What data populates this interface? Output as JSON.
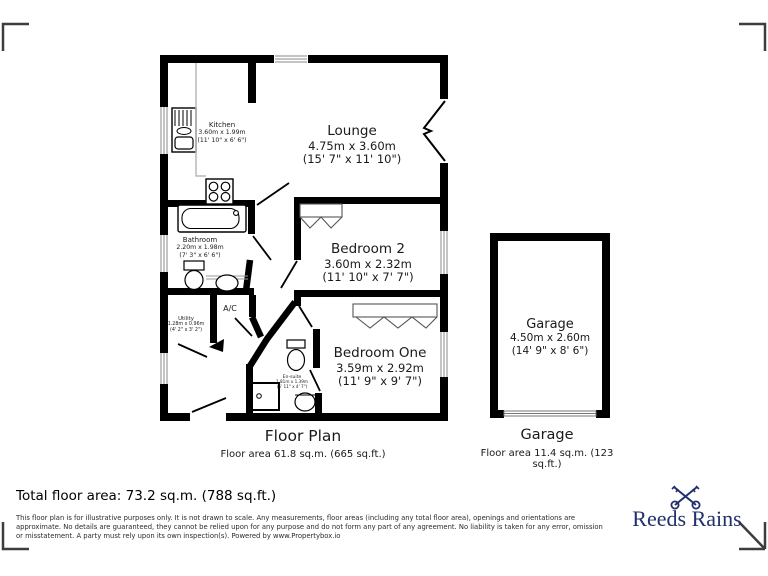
{
  "rooms": {
    "kitchen": {
      "name": "Kitchen",
      "metric": "3.60m x 1.99m",
      "imperial": "(11' 10\" x 6' 6\")"
    },
    "lounge": {
      "name": "Lounge",
      "metric": "4.75m x 3.60m",
      "imperial": "(15' 7\" x 11' 10\")"
    },
    "bathroom": {
      "name": "Bathroom",
      "metric": "2.20m x 1.98m",
      "imperial": "(7' 3\" x 6' 6\")"
    },
    "bedroom2": {
      "name": "Bedroom 2",
      "metric": "3.60m x 2.32m",
      "imperial": "(11' 10\" x 7' 7\")"
    },
    "ac": {
      "name": "A/C"
    },
    "utility": {
      "name": "Utility",
      "metric": "1.28m x 0.96m",
      "imperial": "(4' 2\" x 3' 2\")"
    },
    "bedroom1": {
      "name": "Bedroom One",
      "metric": "3.59m x 2.92m",
      "imperial": "(11' 9\" x 9' 7\")"
    },
    "ensuite": {
      "name": "En-suite",
      "metric": "1.81m x 1.39m",
      "imperial": "(5' 11\" x 4' 7\")"
    },
    "garage": {
      "name": "Garage",
      "metric": "4.50m x 2.60m",
      "imperial": "(14' 9\" x 8' 6\")"
    }
  },
  "captions": {
    "floorplan_title": "Floor Plan",
    "floorplan_area": "Floor area 61.8 sq.m. (665 sq.ft.)",
    "garage_title": "Garage",
    "garage_area": "Floor area 11.4 sq.m. (123 sq.ft.)"
  },
  "footer": {
    "total": "Total floor area: 73.2 sq.m. (788 sq.ft.)",
    "disclaimer": "This floor plan is for illustrative purposes only. It is not drawn to scale. Any measurements, floor areas (including any total floor area), openings and orientations are approximate. No details are guaranteed, they cannot be relied upon for any purpose and do not form any part of any agreement. No liability is taken for any error, omission or misstatement. A party must rely upon its own inspection(s). Powered by www.Propertybox.io"
  },
  "brand": {
    "name": "Reeds Rains",
    "logo_icon": "crossed-keys-icon"
  },
  "colors": {
    "wall": "#000000",
    "window_line": "#8a8a8a",
    "logo_navy": "#22306b",
    "background": "#ffffff"
  }
}
